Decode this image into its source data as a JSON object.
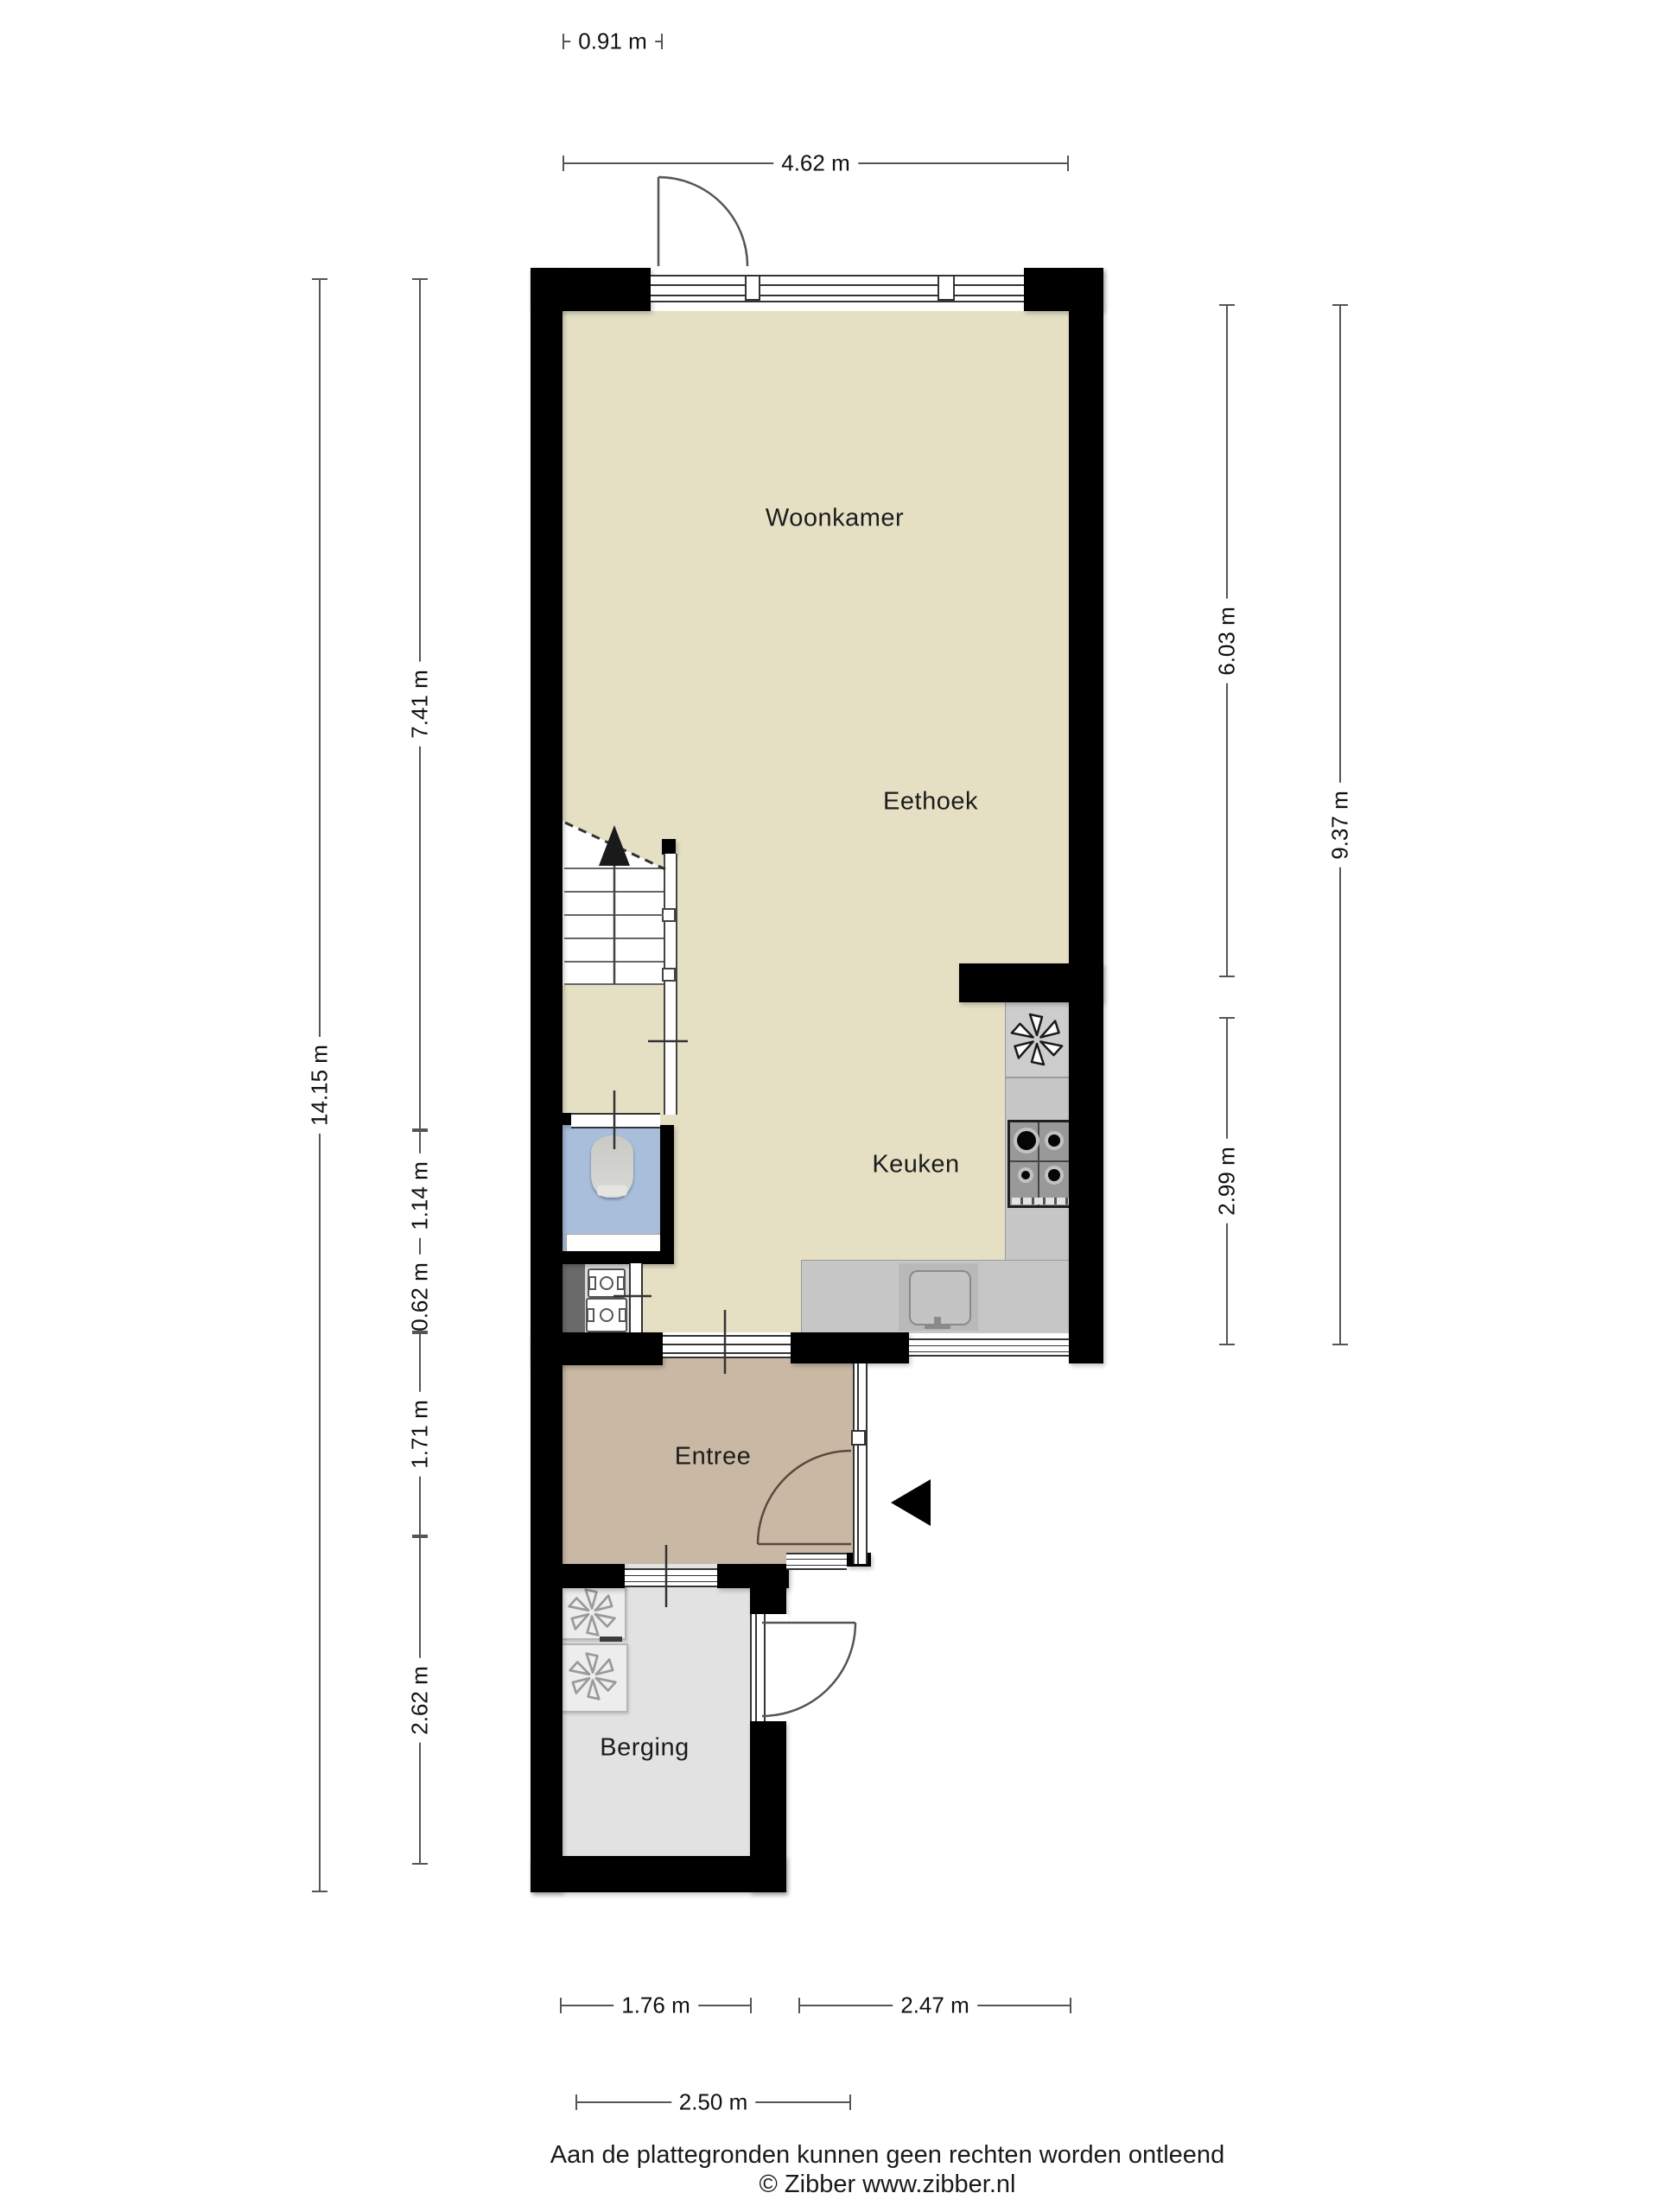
{
  "plan_title": "Begane grond plattegrond",
  "rooms": {
    "woonkamer": "Woonkamer",
    "eethoek": "Eethoek",
    "keuken": "Keuken",
    "entree": "Entree",
    "berging": "Berging"
  },
  "dimensions": {
    "door_top": "0.91 m",
    "top_width": "4.62 m",
    "left_total": "14.15 m",
    "left_living": "7.41 m",
    "left_toilet": "1.14 m",
    "left_meterkast": "0.62 m",
    "left_entree": "1.71 m",
    "left_berging": "2.62 m",
    "right_living": "6.03 m",
    "right_kitchen": "2.99 m",
    "right_total": "9.37 m",
    "bottom_berging": "1.76 m",
    "bottom_kitchen": "2.47 m",
    "bottom_total": "2.50 m"
  },
  "footer": {
    "disclaimer": "Aan de plattegronden kunnen geen rechten worden ontleend",
    "copyright": "© Zibber www.zibber.nl"
  },
  "colors": {
    "wall": "#000000",
    "floor_main": "#e5dfc4",
    "floor_entree": "#c9b9a4",
    "floor_berging": "#e2e2e2",
    "floor_toilet": "#a9bedb",
    "meterkast_strip": "#6a6a6a",
    "counter": "#c6c6c6",
    "dim_line": "#555555"
  },
  "icons": {
    "extractor_fan": "pinwheel-star",
    "stairs_direction": "up-arrow",
    "entrance_marker": "left-triangle"
  }
}
